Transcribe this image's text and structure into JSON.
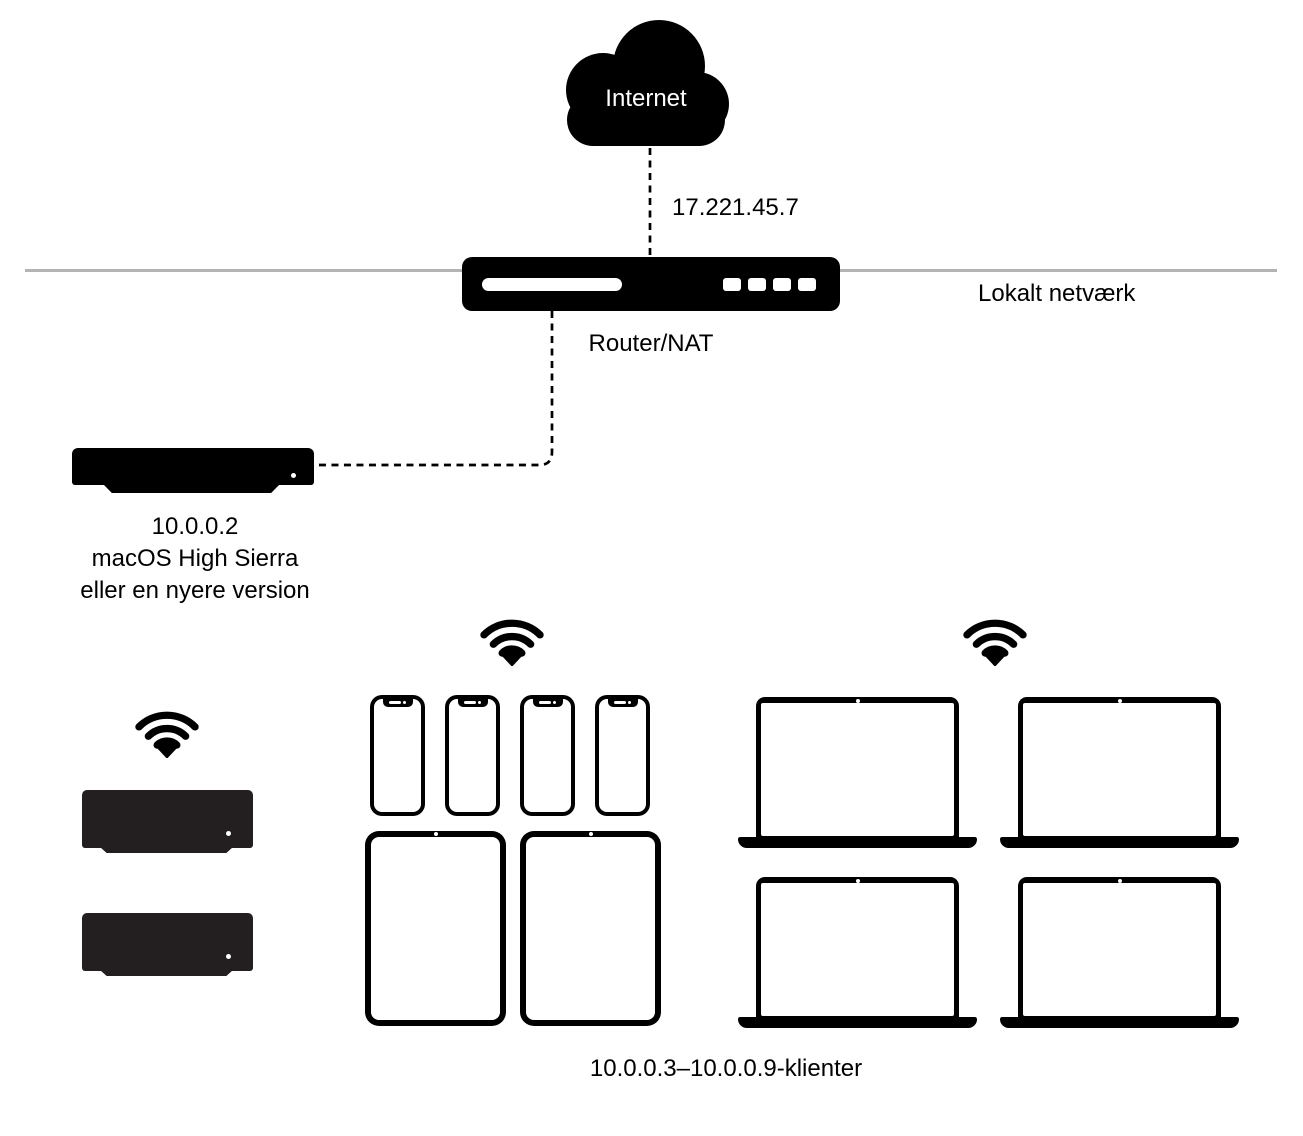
{
  "diagram": {
    "internet_label": "Internet",
    "wan_ip": "17.221.45.7",
    "router_label": "Router/NAT",
    "local_network_label": "Lokalt netværk",
    "server": {
      "line1": "10.0.0.2",
      "line2": "macOS High Sierra",
      "line3": "eller en nyere version"
    },
    "clients_label": "10.0.0.3–10.0.0.9-klienter",
    "client_devices": {
      "mac_mini_count": 2,
      "iphone_count": 4,
      "ipad_count": 2,
      "macbook_count": 4
    },
    "wifi_icon_count": 3
  },
  "icons": {
    "cloud": "internet-cloud-icon",
    "router": "router-icon",
    "mac_mini": "mac-mini-icon",
    "iphone": "iphone-icon",
    "ipad": "ipad-icon",
    "macbook": "macbook-icon",
    "wifi": "wifi-icon"
  },
  "colors": {
    "background": "#ffffff",
    "device_black": "#000000",
    "client_mini_black": "#231f20",
    "local_network_line": "#b3b3b6",
    "text": "#000000",
    "cloud_text": "#ffffff"
  }
}
